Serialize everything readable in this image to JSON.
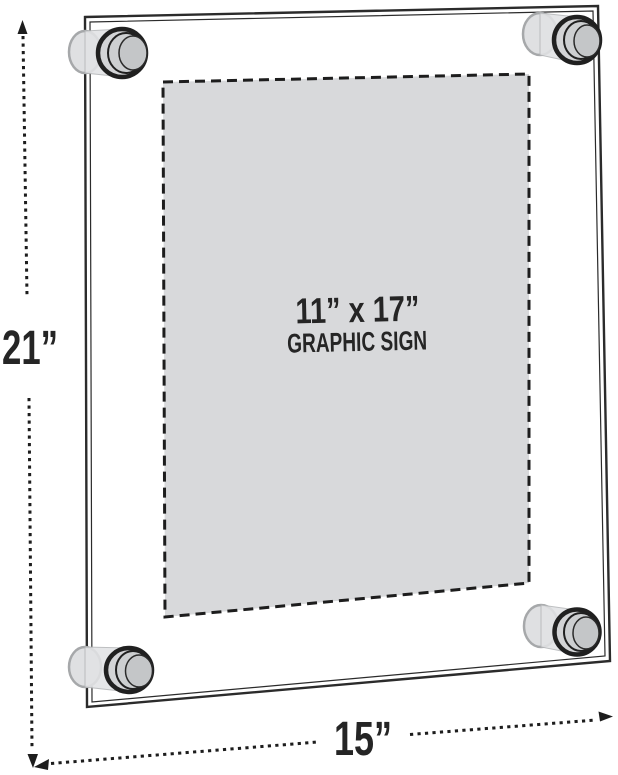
{
  "labels": {
    "height": "21”",
    "width": "15”",
    "graphic_line1": "11” x 17”",
    "graphic_line2": "GRAPHIC SIGN"
  },
  "colors": {
    "background": "#ffffff",
    "outline": "#2b2b2b",
    "dimension_line": "#1d1d1d",
    "graphic_area_fill": "#d8d9db",
    "standoff_back_fill": "#dfe0e2",
    "standoff_body_fill": "#e2e3e5",
    "standoff_lip_fill": "#d3d4d6",
    "standoff_ring_fill": "#cdcfd1",
    "standoff_face_fill": "#c4c6c8"
  }
}
